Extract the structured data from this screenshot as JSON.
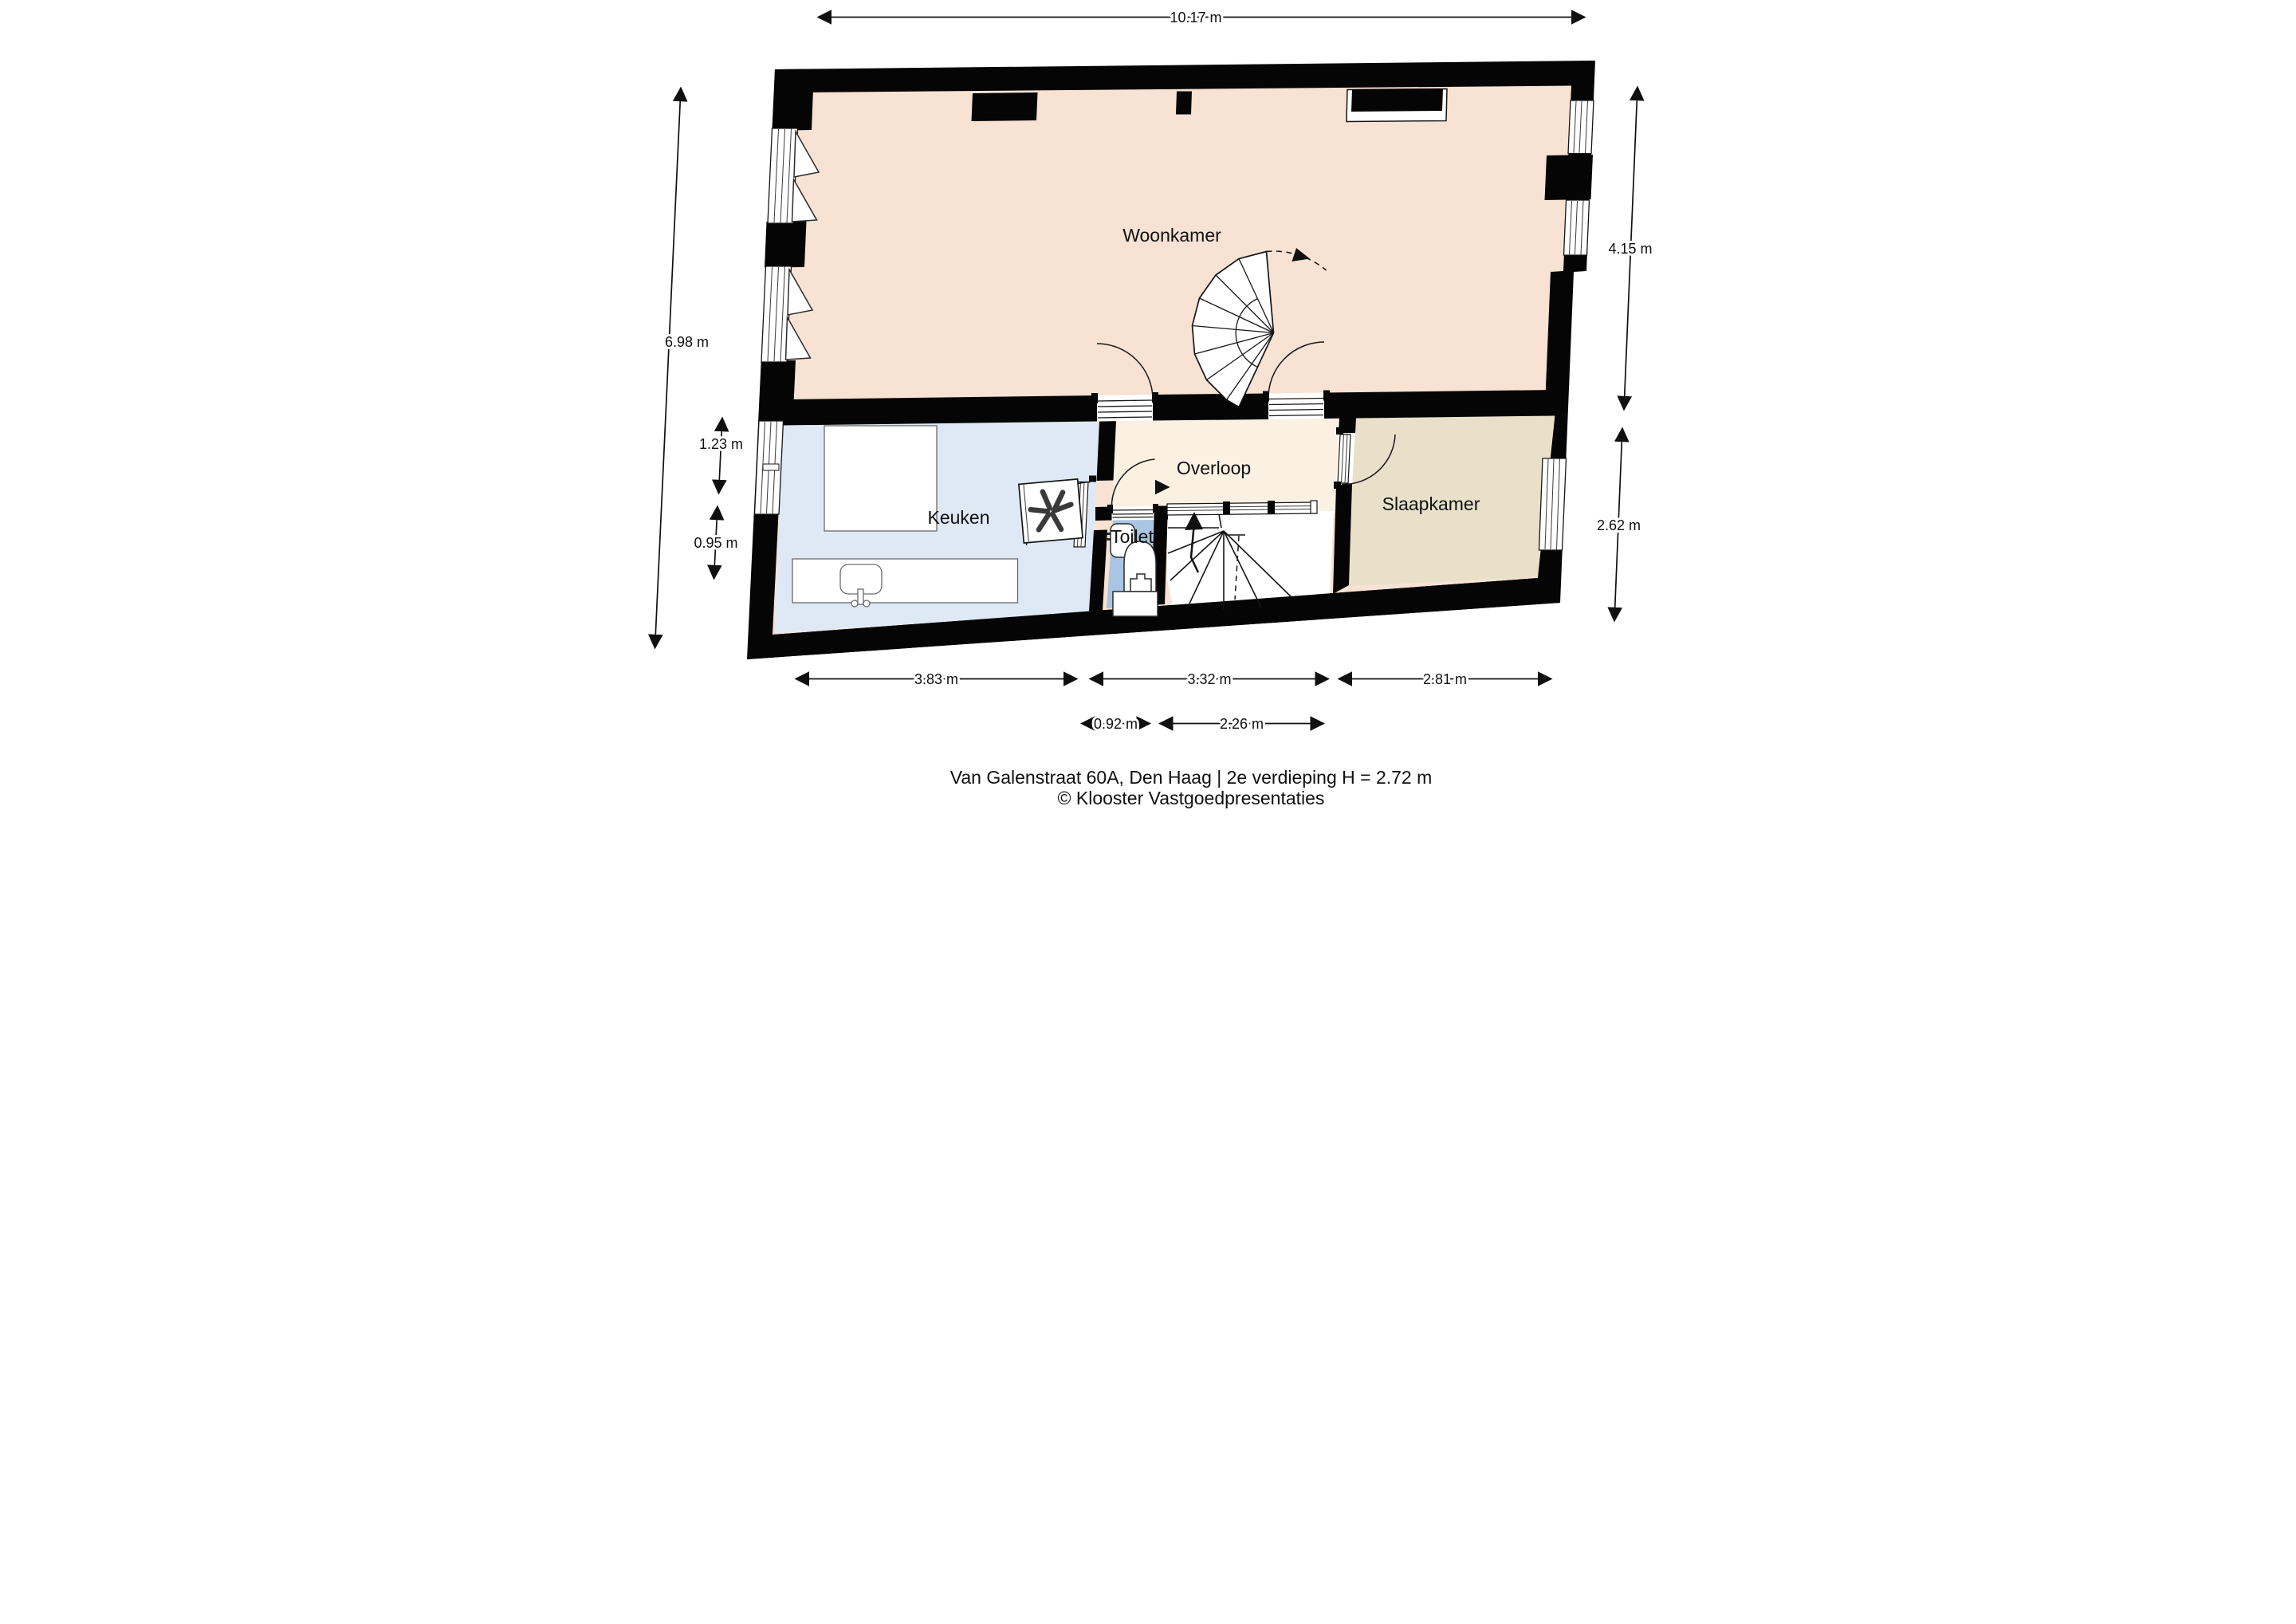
{
  "plan": {
    "type": "floorplan",
    "floor_note": "2e verdieping",
    "ceiling_height": "H = 2.72 m"
  },
  "title": {
    "line1": "Van Galenstraat 60A, Den Haag | 2e verdieping  H = 2.72 m",
    "line2": "© Klooster Vastgoedpresentaties"
  },
  "rooms": [
    {
      "id": "woonkamer",
      "label": "Woonkamer"
    },
    {
      "id": "keuken",
      "label": "Keuken"
    },
    {
      "id": "overloop",
      "label": "Overloop"
    },
    {
      "id": "toilet",
      "label": "Toilet"
    },
    {
      "id": "slaapkamer",
      "label": "Slaapkamer"
    }
  ],
  "dimensions": {
    "top_width": "10.17 m",
    "left_height": "6.98 m",
    "left_window": "1.23 m",
    "left_wall_segment": "0.95 m",
    "right_woonkamer_depth": "4.15 m",
    "right_slaapkamer_depth": "2.62 m",
    "bottom_keuken_width": "3.83 m",
    "bottom_overloop_width": "3.32 m",
    "bottom_slaapkamer_width": "2.81 m",
    "bottom_toilet_width": "0.92 m",
    "bottom_stairs_width": "2.26 m"
  },
  "colors": {
    "woonkamer": "#f7e2d3",
    "keuken": "#dfe9f6",
    "overloop": "#faf1e3",
    "slaapkamer": "#e9e0c9",
    "toilet": "#a9c5e3",
    "walls": "#050505",
    "background": "#ffffff"
  }
}
